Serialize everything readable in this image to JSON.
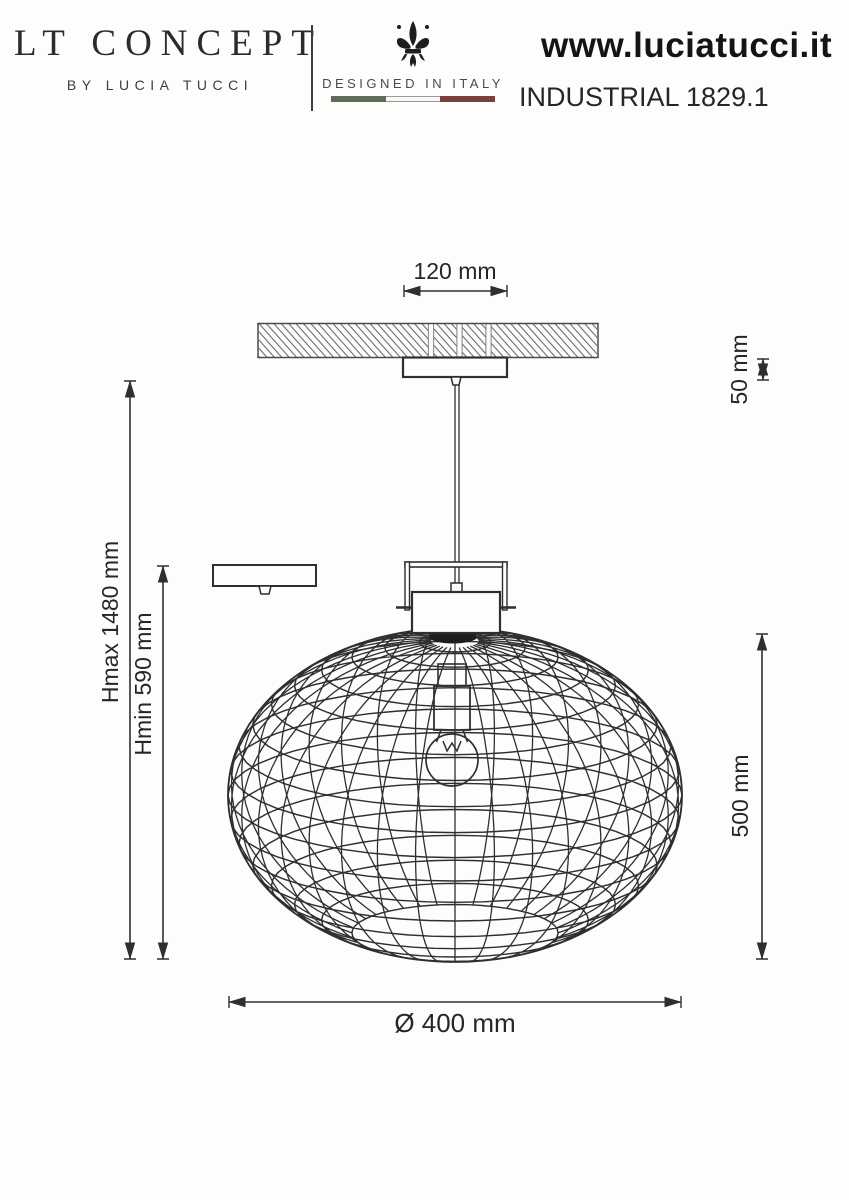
{
  "header": {
    "brand": {
      "logo": "LT CONCEPT",
      "subtitle": "BY LUCIA TUCCI"
    },
    "made_in": {
      "label": "DESIGNED IN ITALY",
      "flag_colors": [
        "#5f6b55",
        "#f8f8f6",
        "#7a403b"
      ]
    },
    "website": "www.luciatucci.it",
    "model": "INDUSTRIAL 1829.1"
  },
  "drawing": {
    "line_color": "#2f2f2f",
    "labels": {
      "canopy_width": "120 mm",
      "canopy_height": "50 mm",
      "height_max": "Hmax 1480 mm",
      "height_min": "Hmin 590 mm",
      "shade_height": "500 mm",
      "shade_diameter": "Ø 400 mm"
    }
  }
}
